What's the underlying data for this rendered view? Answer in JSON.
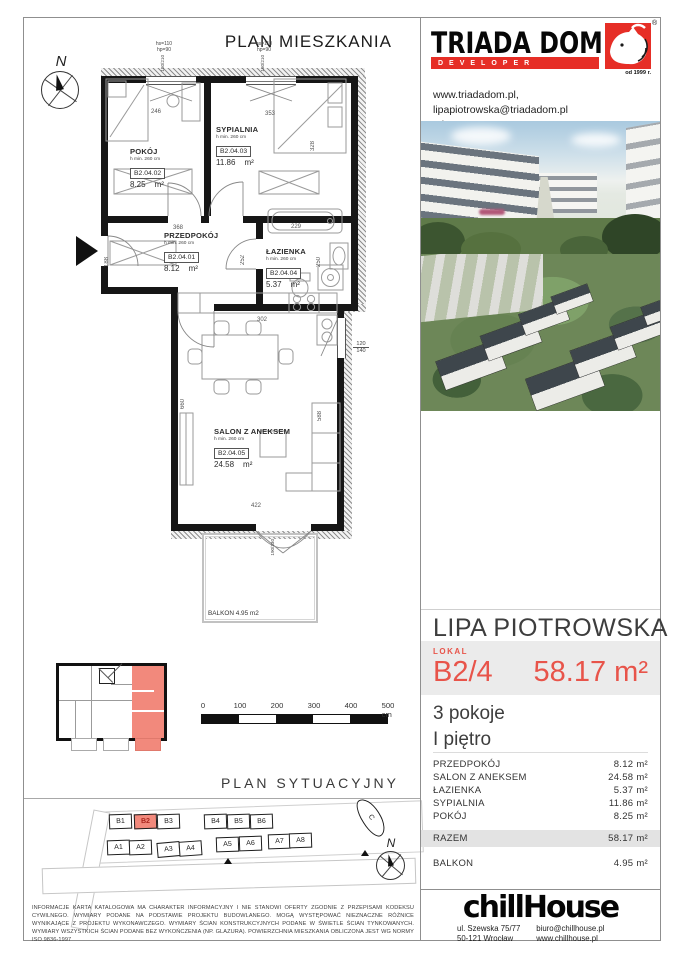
{
  "page": {
    "title": "PLAN MIESZKANIA"
  },
  "developer": {
    "name": "TRIADA DOM",
    "tagline": "DEVELOPER",
    "registered": "®",
    "since": "od 1999 r.",
    "website": "www.triadadom.pl,",
    "email": "lipapiotrowska@triadadom.pl",
    "phone": "tel. 880 789 700; 71 394 10 00"
  },
  "compass": {
    "north": "N"
  },
  "floorplan": {
    "window_note_line1": "hs=110",
    "window_note_line2": "hp=90",
    "window_size": "180/210",
    "balcony_door_size": "190/230",
    "side_window_w": "120",
    "side_window_w2": "140",
    "rooms": [
      {
        "name": "POKÓJ",
        "height_note": "h min. 260 cm",
        "code": "B2.04.02",
        "area": "8.25",
        "unit": "m²"
      },
      {
        "name": "SYPIALNIA",
        "height_note": "h min. 260 cm",
        "code": "B2.04.03",
        "area": "11.86",
        "unit": "m²"
      },
      {
        "name": "PRZEDPOKÓJ",
        "height_note": "h min. 260 cm",
        "code": "B2.04.01",
        "area": "8.12",
        "unit": "m²"
      },
      {
        "name": "ŁAZIENKA",
        "height_note": "h min. 260 cm",
        "code": "B2.04.04",
        "area": "5.37",
        "unit": "m²"
      },
      {
        "name": "SALON Z ANEKSEM",
        "height_note": "h min. 260 cm",
        "code": "B2.04.05",
        "area": "24.58",
        "unit": "m²"
      }
    ],
    "balcony_label": "BALKON  4.95 m2",
    "dims": {
      "d246": "246",
      "d353": "353",
      "d328": "328",
      "d368": "368",
      "d229": "229",
      "d188": "188",
      "d252": "252",
      "d250": "250",
      "d302": "302",
      "d660": "660",
      "d588": "588",
      "d422": "422"
    }
  },
  "scalebar": {
    "t0": "0",
    "t100": "100",
    "t200": "200",
    "t300": "300",
    "t400": "400",
    "t500": "500 cm"
  },
  "siteplan": {
    "title": "PLAN  SYTUACYJNY",
    "blocks_b": [
      "B1",
      "B2",
      "B3",
      "B4",
      "B5",
      "B6"
    ],
    "blocks_a": [
      "A1",
      "A2",
      "A3",
      "A4",
      "A5",
      "A6",
      "A7",
      "A8"
    ],
    "block_c": "C",
    "north": "N"
  },
  "disclaimer": "INFORMACJE KARTA KATALOGOWA MA CHARAKTER INFORMACYJNY I NIE STANOWI OFERTY ZGODNIE Z PRZEPISAMI KODEKSU CYWILNEGO. WYMIARY PODANE NA PODSTAWIE PROJEKTU BUDOWLANEGO. MOGĄ WYSTĘPOWAĆ NIEZNACZNE RÓŻNICE WYNIKAJĄCE Z PROJEKTU WYKONAWCZEGO. WYMIARY ŚCIAN KONSTRUKCYJNYCH PODANE W ŚWIETLE ŚCIAN TYNKOWANYCH. WYMIARY WSZYSTKICH ŚCIAN PODANE BEZ WYKOŃCZENIA (NP. GLAZURA). POWIERZCHNIA MIESZKANIA OBLICZONA JEST WG NORMY ISO 9836-1997",
  "offer": {
    "project": "LIPA PIOTROWSKA",
    "unit_label": "LOKAL",
    "unit_number": "B2/4",
    "unit_area": "58.17 m²",
    "rooms_count": "3 pokoje",
    "floor": "I piętro",
    "areas": [
      {
        "name": "PRZEDPOKÓJ",
        "value": "8.12 m²"
      },
      {
        "name": "SALON Z ANEKSEM",
        "value": "24.58 m²"
      },
      {
        "name": "ŁAZIENKA",
        "value": "5.37 m²"
      },
      {
        "name": "SYPIALNIA",
        "value": "11.86 m²"
      },
      {
        "name": "POKÓJ",
        "value": "8.25 m²"
      }
    ],
    "total": {
      "name": "RAZEM",
      "value": "58.17 m²"
    },
    "balcony": {
      "name": "BALKON",
      "value": "4.95 m²"
    }
  },
  "agency": {
    "logo": "chillHouse",
    "address_line1": "ul. Szewska 75/77",
    "address_line2": "50-121 Wrocław",
    "email": "biuro@chillhouse.pl",
    "website": "www.chillhouse.pl"
  },
  "colors": {
    "accent_red": "#e8544a",
    "developer_red": "#e62e26",
    "highlight_fill": "#f2897c",
    "band_gray": "#ebebeb"
  }
}
